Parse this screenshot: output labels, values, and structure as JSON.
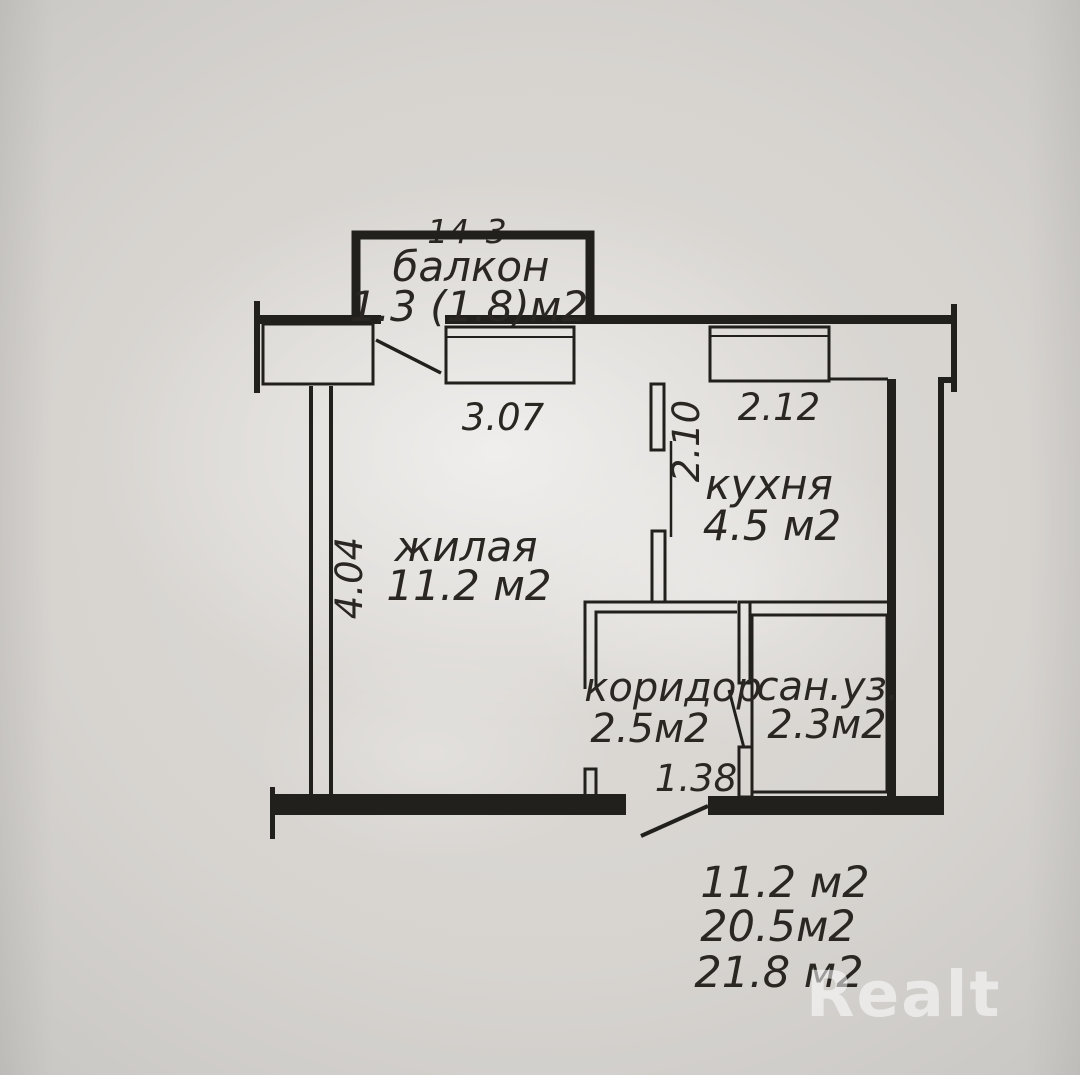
{
  "photo": {
    "paper_color": "#d7d4d0",
    "ink_color": "#22201c"
  },
  "plan": {
    "unit_number": "14–3",
    "rooms": [
      {
        "id": "balcony",
        "name": "балкон",
        "area": "1.3 (1.8)м2"
      },
      {
        "id": "living",
        "name": "жилая",
        "area": "11.2 м2"
      },
      {
        "id": "kitchen",
        "name": "кухня",
        "area": "4.5 м2"
      },
      {
        "id": "corridor",
        "name": "коридор",
        "area": "2.5м2"
      },
      {
        "id": "bathroom",
        "name": "сан.уз.",
        "area": "2.3м2"
      }
    ],
    "dimensions": {
      "living_width": "3.07",
      "kitchen_width": "2.12",
      "kitchen_depth": "2.10",
      "living_depth": "4.04",
      "corridor_width": "1.38"
    },
    "totals": [
      "11.2 м2",
      "20.5м2",
      "21.8 м2"
    ]
  },
  "watermark": {
    "text": "Realt"
  }
}
